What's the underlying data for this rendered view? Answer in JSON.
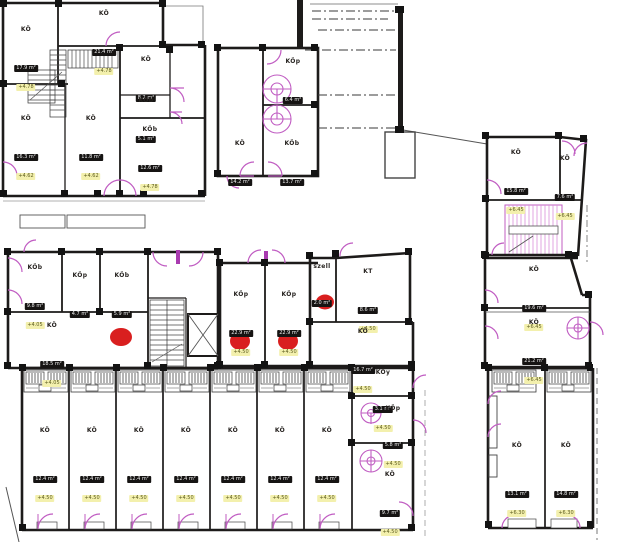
{
  "drawing": {
    "kind": "architectural floor plan",
    "annotations": {
      "marker_red": "#d91f1f",
      "door_magenta": "#c05cc2",
      "wall": "#1d1b1a",
      "elev_chip_bg": "#f3f0ad",
      "dims_box_bg": "#161413"
    }
  },
  "rooms": [
    {
      "name": "KÖ",
      "area": "17.9 m²",
      "elev": "+4.78"
    },
    {
      "name": "KÖ",
      "area": "21.4 m²",
      "elev": "+4.78"
    },
    {
      "name": "KÖ",
      "area": "8.2 m²",
      "elev": null
    },
    {
      "name": "KÖb",
      "area": "5.1 m²",
      "elev": null
    },
    {
      "name": "KÖb",
      "area": "12.6 m²",
      "elev": "+4.78"
    },
    {
      "name": "KÖ",
      "area": "16.3 m²",
      "elev": "+4.62"
    },
    {
      "name": "KÖ",
      "area": "11.8 m²",
      "elev": "+4.62"
    },
    {
      "name": "KÖp",
      "area": "6.4 m²",
      "elev": null
    },
    {
      "name": "KÖ",
      "area": "14.2 m²",
      "elev": null
    },
    {
      "name": "KÖb",
      "area": "13.7 m²",
      "elev": null
    },
    {
      "name": "KÖ",
      "area": "15.8 m²",
      "elev": "+6.45"
    },
    {
      "name": "KÖ",
      "area": "7.6 m²",
      "elev": "+6.45"
    },
    {
      "name": "KÖb",
      "area": "9.8 m²",
      "elev": "+4.05"
    },
    {
      "name": "KÖp",
      "area": "4.7 m²",
      "elev": null
    },
    {
      "name": "KÖb",
      "area": "5.9 m²",
      "elev": null
    },
    {
      "name": "KÖ",
      "area": "18.5 m²",
      "elev": "+4.05"
    },
    {
      "name": "KÖp",
      "area": "22.9 m²",
      "elev": "+4.50"
    },
    {
      "name": "KÖp",
      "area": "22.9 m²",
      "elev": "+4.50"
    },
    {
      "name": "szell",
      "area": "2.0 m²",
      "elev": null
    },
    {
      "name": "KT",
      "area": "8.6 m²",
      "elev": "+4.50"
    },
    {
      "name": "KÖ",
      "area": "16.7 m²",
      "elev": "+4.50"
    },
    {
      "name": "KÖ",
      "area": "19.6 m²",
      "elev": "+6.45"
    },
    {
      "name": "KÖ",
      "area": "21.2 m²",
      "elev": "+6.45"
    },
    {
      "name": "KÖy",
      "area": "3.1 m²",
      "elev": "+4.50"
    },
    {
      "name": "KÖp",
      "area": "5.8 m²",
      "elev": "+4.50"
    },
    {
      "name": "KÖ",
      "area": "9.7 m²",
      "elev": "+4.50"
    },
    {
      "name": "KÖ",
      "area": "12.4 m²",
      "elev": "+4.50"
    },
    {
      "name": "KÖ",
      "area": "12.4 m²",
      "elev": "+4.50"
    },
    {
      "name": "KÖ",
      "area": "12.4 m²",
      "elev": "+4.50"
    },
    {
      "name": "KÖ",
      "area": "12.4 m²",
      "elev": "+4.50"
    },
    {
      "name": "KÖ",
      "area": "12.4 m²",
      "elev": "+4.50"
    },
    {
      "name": "KÖ",
      "area": "12.4 m²",
      "elev": "+4.50"
    },
    {
      "name": "KÖ",
      "area": "12.4 m²",
      "elev": "+4.50"
    },
    {
      "name": "KÖ",
      "area": "13.1 m²",
      "elev": "+6.30"
    },
    {
      "name": "KÖ",
      "area": "14.8 m²",
      "elev": "+6.30"
    }
  ]
}
